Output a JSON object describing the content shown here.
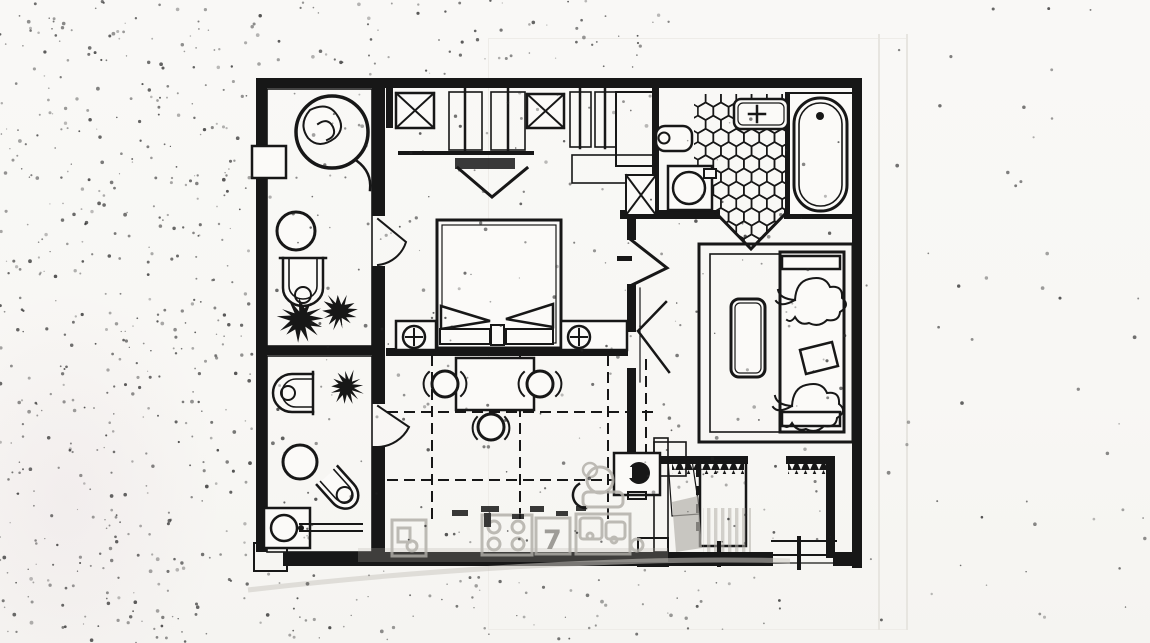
{
  "document": {
    "type": "scanned-floor-plan",
    "description": "Black-and-white hand-drafted apartment/suite floor plan, photocopied with heavy speckle noise on the left margin and gray ghosted bleed-through of kitchen fixtures along the bottom edge",
    "visible_text": []
  },
  "colors": {
    "paper": "#f8f7f4",
    "paper_bright": "#fbfaf8",
    "ink": "#171717",
    "ghost": "#b3b0aa",
    "ghost_dark": "#8f8d88",
    "noise": "#262626",
    "sheet_line": "#e7e5e0"
  },
  "noise": {
    "speckle_count": 950
  },
  "ghost": {
    "seven_label": "7"
  },
  "rooms": [
    {
      "name": "top-left-bathroom",
      "floor": "diamond-lattice-tile",
      "fixtures": [
        "whirlpool-spa-tub",
        "wall-niche",
        "round-wash-basin",
        "toilet",
        "potted-plant",
        "potted-plant"
      ]
    },
    {
      "name": "walk-in-closet",
      "fixtures": [
        "x-shelf-cabinet",
        "hanging-clothes-rail",
        "hanging-clothes-rail",
        "luggage-bench",
        "x-shelf-cabinet",
        "hanging-clothes-rail",
        "mirror-panel",
        "hatched-shelf"
      ]
    },
    {
      "name": "top-right-bathroom",
      "floor": "honeycomb-tile",
      "fixtures": [
        "wash-basin",
        "wall-hung-toilet",
        "washing-machine",
        "x-cabinet",
        "bathtub"
      ]
    },
    {
      "name": "bedroom",
      "fixtures": [
        "double-bed-with-two-pillows",
        "nightstand-with-lamp",
        "nightstand-with-lamp",
        "table",
        "chair",
        "chair",
        "chair"
      ],
      "floor": "dashed-grid"
    },
    {
      "name": "living-room",
      "fixtures": [
        "area-rug",
        "coffee-table",
        "sofa",
        "floral-throw",
        "floral-throw",
        "cushion",
        "radiator",
        "radiator",
        "double-swing-door"
      ]
    },
    {
      "name": "lower-left-bathroom",
      "floor": "diamond-lattice-tile",
      "fixtures": [
        "toilet",
        "potted-plant",
        "round-wash-basin",
        "bidet",
        "water-heater"
      ]
    },
    {
      "name": "wc",
      "fixtures": [
        "toilet-with-tank",
        "paper-holder"
      ]
    },
    {
      "name": "entry-corridor",
      "fixtures": [
        "wardrobe",
        "entry-door-threshold"
      ]
    },
    {
      "name": "ghost-bleedthrough",
      "fixtures": [
        "cabinet",
        "four-burner-stove",
        "numbered-box",
        "double-sink",
        "kettle"
      ]
    }
  ]
}
